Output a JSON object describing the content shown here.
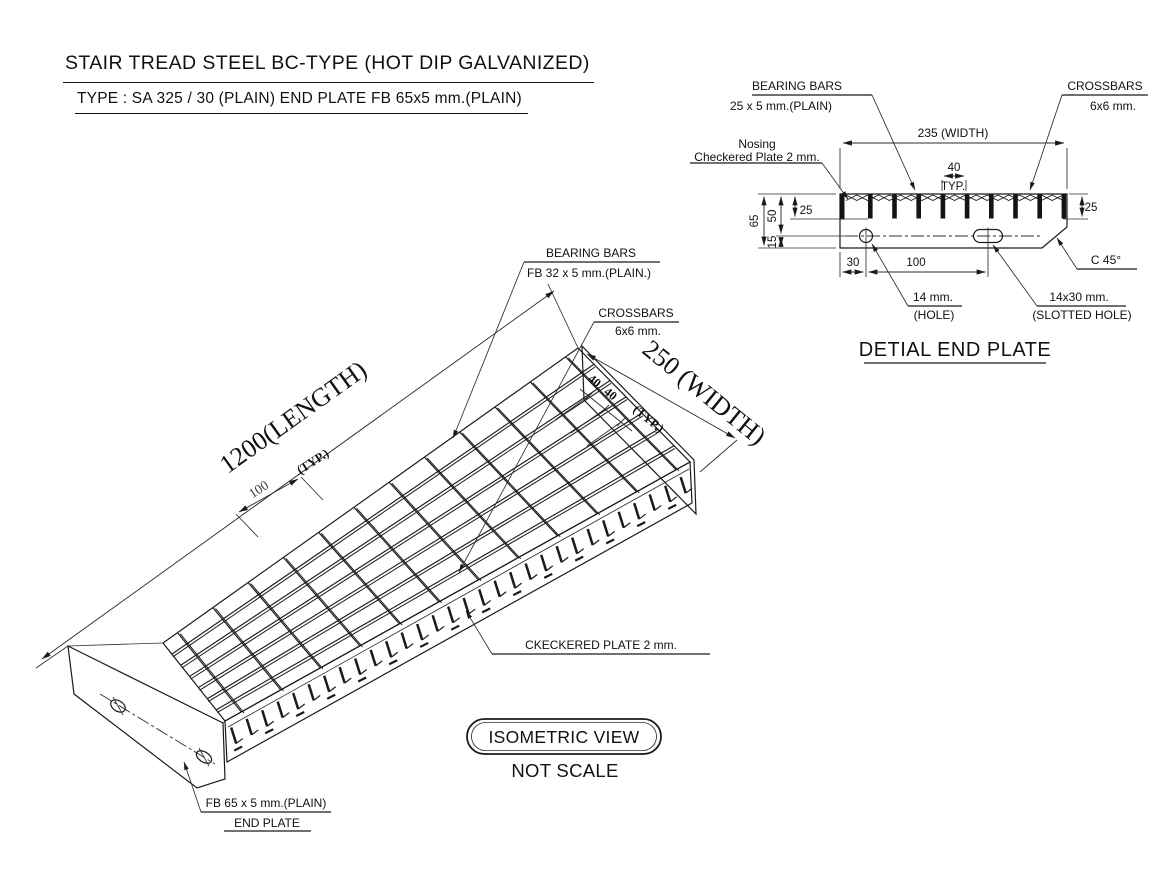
{
  "header": {
    "title": "STAIR TREAD STEEL BC-TYPE (HOT DIP GALVANIZED)",
    "subtitle": "TYPE : SA  325 / 30  (PLAIN)  END PLATE FB 65x5 mm.(PLAIN)"
  },
  "detail": {
    "caption": "DETIAL END PLATE",
    "labels": {
      "bearing_bars_1": "BEARING BARS",
      "bearing_bars_2": "25 x 5  mm.(PLAIN)",
      "crossbars_1": "CROSSBARS",
      "crossbars_2": "6x6 mm.",
      "nosing_1": "Nosing",
      "nosing_2": "Checkered Plate  2 mm.",
      "hole_1": "14 mm.",
      "hole_2": "(HOLE)",
      "slot_1": "14x30 mm.",
      "slot_2": "(SLOTTED HOLE)",
      "chamfer": "C 45°"
    },
    "dims": {
      "width": "235 (WIDTH)",
      "pitch": "40",
      "pitch_typ": "TYP.",
      "height": "65",
      "upper": "50",
      "lower": "15",
      "bar_left": "25",
      "bar_right": "25",
      "edge": "30",
      "hole_pitch": "100"
    }
  },
  "iso": {
    "caption": "ISOMETRIC VIEW",
    "note": "NOT SCALE",
    "labels": {
      "bearing_bars_1": "BEARING BARS",
      "bearing_bars_2": "FB  32 x 5  mm.(PLAIN.)",
      "crossbars_1": "CROSSBARS",
      "crossbars_2": "6x6 mm.",
      "checkered_plate": "CKECKERED PLATE  2  mm.",
      "end_plate_1": "FB 65 x 5 mm.(PLAIN)",
      "end_plate_2": "END PLATE"
    },
    "dims": {
      "length": "1200(LENGTH)",
      "width": "250 (WIDTH)",
      "crossbar_pitch": "100",
      "crossbar_typ": "(TYP.)",
      "bar_pitch_a": "40",
      "bar_pitch_b": "40",
      "bar_typ": "(TYP.)"
    }
  }
}
